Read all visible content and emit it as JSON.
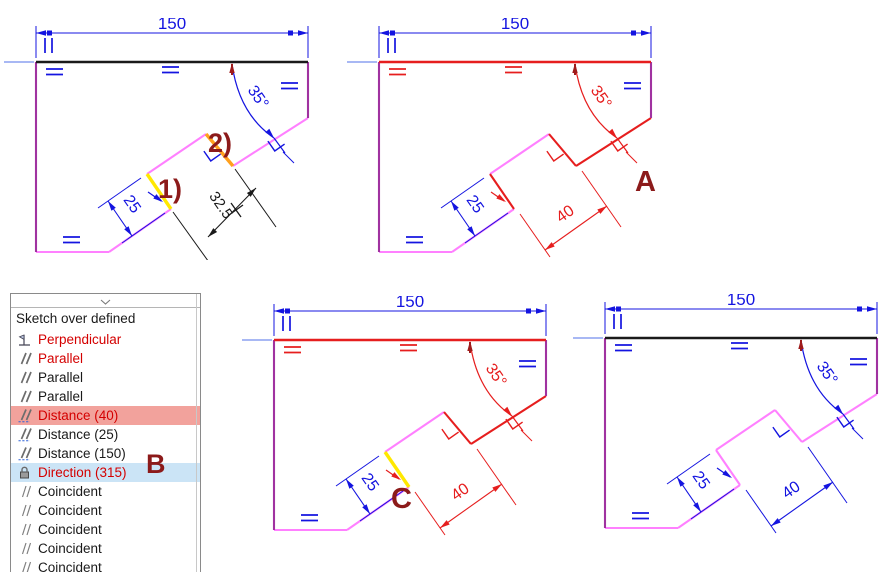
{
  "palette": {
    "dimension_blue": "#1414E0",
    "axis_blue": "#8CA0F0",
    "overdefined_red": "#E61E1E",
    "geometry_pink": "#FF80FF",
    "geometry_purple": "#A032A0",
    "geometry_black": "#1A1A1A",
    "highlight_yellow": "#FFE800",
    "highlight_orange": "#FFA01E",
    "callout_darkred": "#8C1A1A",
    "arc_tick_red": "#9E1B1B",
    "list_red_text": "#D40000",
    "list_black_text": "#1A1A1A",
    "row_highlight_salmon": "#F2A29C",
    "row_highlight_blue": "#CBE4F6"
  },
  "sketches": [
    {
      "id": "sketch-top-left",
      "dims": {
        "width": {
          "value": "150",
          "color": "#1414E0"
        },
        "angle": {
          "value": "35°",
          "color": "#1414E0"
        },
        "step": {
          "value": "25",
          "color": "#1414E0",
          "leader_color": "#1414E0"
        },
        "reference": {
          "value": "32.5",
          "color": "#1A1A1A"
        }
      },
      "edges": {
        "top": "#1A1A1A",
        "right": "#A032A0",
        "chamfer": "#FF80FF",
        "step_upper": "#FFA01E",
        "inner": "#FF80FF",
        "step_lower": "#FFE800",
        "diagonal": "#FF80FF",
        "bottom": "#FF80FF",
        "left": "#A032A0"
      },
      "glyphs": {
        "eq_top_left": "#1414E0",
        "eq_top_mid": "#1414E0",
        "eq_right": "#1414E0",
        "eq_bottom": "#1414E0",
        "perp": "#1414E0"
      },
      "callouts": [
        {
          "text": "1)",
          "x": 122,
          "y": 136
        },
        {
          "text": "2)",
          "x": 172,
          "y": 90
        }
      ]
    },
    {
      "id": "sketch-A",
      "dims": {
        "width": {
          "value": "150",
          "color": "#1414E0"
        },
        "angle": {
          "value": "35°",
          "color": "#E61E1E"
        },
        "step": {
          "value": "25",
          "color": "#1414E0",
          "leader_color": "#E61E1E"
        },
        "length": {
          "value": "40",
          "color": "#E61E1E"
        }
      },
      "edges": {
        "top": "#E61E1E",
        "right": "#A032A0",
        "chamfer": "#E61E1E",
        "step_upper": "#E61E1E",
        "inner": "#FF80FF",
        "step_lower": "#E61E1E",
        "diagonal": "#FF80FF",
        "bottom": "#FF80FF",
        "left": "#A032A0"
      },
      "glyphs": {
        "eq_top_left": "#E61E1E",
        "eq_top_mid": "#E61E1E",
        "eq_right": "#1414E0",
        "eq_bottom": "#1414E0",
        "perp": "#E61E1E"
      },
      "callouts": [
        {
          "text": "A",
          "x": 256,
          "y": 129
        }
      ]
    },
    {
      "id": "sketch-C",
      "dims": {
        "width": {
          "value": "150",
          "color": "#1414E0"
        },
        "angle": {
          "value": "35°",
          "color": "#E61E1E"
        },
        "step": {
          "value": "25",
          "color": "#1414E0",
          "leader_color": "#E61E1E"
        },
        "length": {
          "value": "40",
          "color": "#E61E1E"
        }
      },
      "edges": {
        "top": "#E61E1E",
        "right": "#A032A0",
        "chamfer": "#E61E1E",
        "step_upper": "#E61E1E",
        "inner": "#FF80FF",
        "step_lower": "#FFE800",
        "diagonal": "#FF80FF",
        "bottom": "#FF80FF",
        "left": "#A032A0"
      },
      "glyphs": {
        "eq_top_left": "#E61E1E",
        "eq_top_mid": "#E61E1E",
        "eq_right": "#1414E0",
        "eq_bottom": "#1414E0",
        "perp": "#E61E1E"
      },
      "callouts": [
        {
          "text": "C",
          "x": 117,
          "y": 168
        }
      ]
    },
    {
      "id": "sketch-D",
      "dims": {
        "width": {
          "value": "150",
          "color": "#1414E0"
        },
        "angle": {
          "value": "35°",
          "color": "#1414E0"
        },
        "step": {
          "value": "25",
          "color": "#1414E0",
          "leader_color": "#1414E0"
        },
        "length": {
          "value": "40",
          "color": "#1414E0"
        }
      },
      "edges": {
        "top": "#1A1A1A",
        "right": "#A032A0",
        "chamfer": "#FF80FF",
        "step_upper": "#FF80FF",
        "inner": "#FF80FF",
        "step_lower": "#FF80FF",
        "diagonal": "#FF80FF",
        "bottom": "#FF80FF",
        "left": "#A032A0"
      },
      "glyphs": {
        "eq_top_left": "#1414E0",
        "eq_top_mid": "#1414E0",
        "eq_right": "#1414E0",
        "eq_bottom": "#1414E0",
        "perp": "#1414E0"
      },
      "callouts": []
    }
  ],
  "panel": {
    "title": "Sketch over defined",
    "overlay_label": "B",
    "items": [
      {
        "icon": "perpendicular-icon",
        "label": "Perpendicular",
        "text_color": "#D40000",
        "highlight": null
      },
      {
        "icon": "parallel-icon",
        "label": "Parallel",
        "text_color": "#D40000",
        "highlight": null
      },
      {
        "icon": "parallel-icon",
        "label": "Parallel",
        "text_color": "#1A1A1A",
        "highlight": null
      },
      {
        "icon": "parallel-icon",
        "label": "Parallel",
        "text_color": "#1A1A1A",
        "highlight": null
      },
      {
        "icon": "distance-icon",
        "label": "Distance (40)",
        "text_color": "#D40000",
        "highlight": "#F2A29C"
      },
      {
        "icon": "distance-icon",
        "label": "Distance (25)",
        "text_color": "#1A1A1A",
        "highlight": null
      },
      {
        "icon": "distance-icon",
        "label": "Distance (150)",
        "text_color": "#1A1A1A",
        "highlight": null
      },
      {
        "icon": "lock-icon",
        "label": "Direction (315)",
        "text_color": "#D40000",
        "highlight": "#CBE4F6"
      },
      {
        "icon": "coincident-icon",
        "label": "Coincident",
        "text_color": "#1A1A1A",
        "highlight": null
      },
      {
        "icon": "coincident-icon",
        "label": "Coincident",
        "text_color": "#1A1A1A",
        "highlight": null
      },
      {
        "icon": "coincident-icon",
        "label": "Coincident",
        "text_color": "#1A1A1A",
        "highlight": null
      },
      {
        "icon": "coincident-icon",
        "label": "Coincident",
        "text_color": "#1A1A1A",
        "highlight": null
      },
      {
        "icon": "coincident-icon",
        "label": "Coincident",
        "text_color": "#1A1A1A",
        "highlight": null
      }
    ]
  }
}
